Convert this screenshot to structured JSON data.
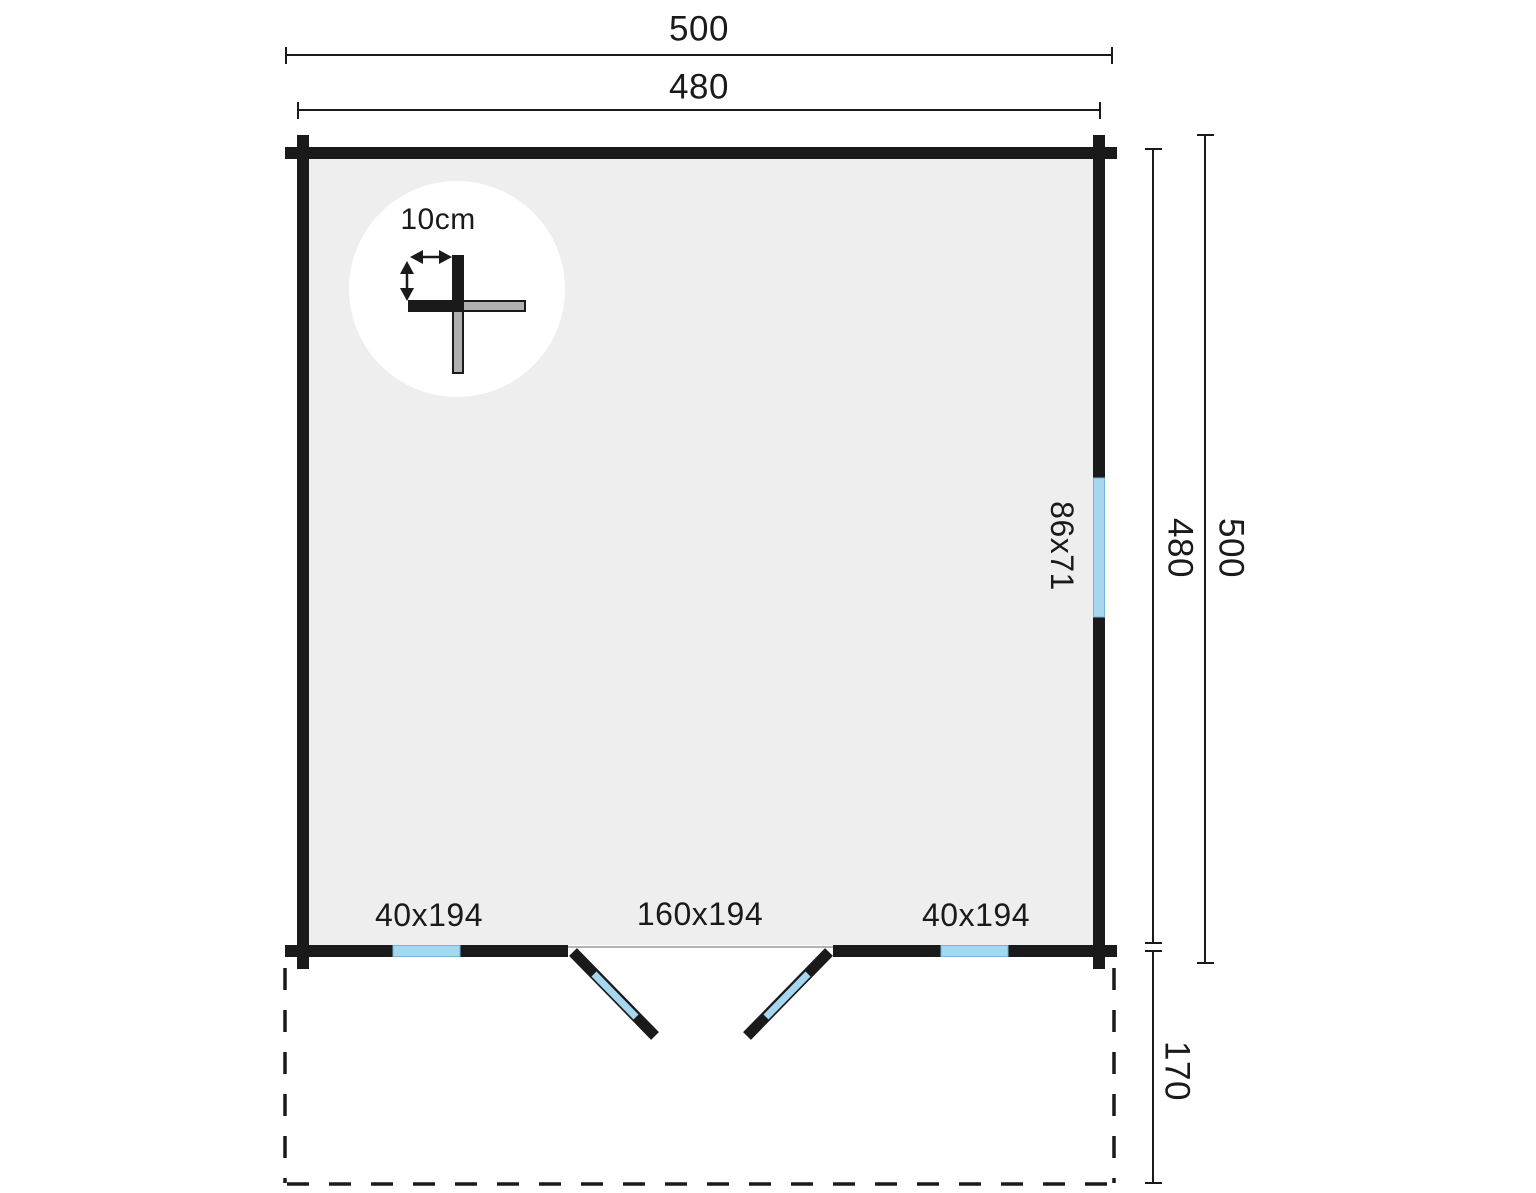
{
  "floor_plan": {
    "dimensions": {
      "top_overall": "500",
      "top_inner": "480",
      "right_inner": "480",
      "right_overall": "500",
      "terrace_depth": "170"
    },
    "openings": {
      "side_window": "86x71",
      "front_window_left": "40x194",
      "front_door": "160x194",
      "front_window_right": "40x194"
    },
    "detail": {
      "wall_thickness": "10cm"
    },
    "colors": {
      "wall": "#1a1a1a",
      "interior": "#efeeee",
      "glass": "#a5d8ef",
      "log_gray": "#b0b0b0",
      "dim_line": "#1a1a1a"
    }
  }
}
